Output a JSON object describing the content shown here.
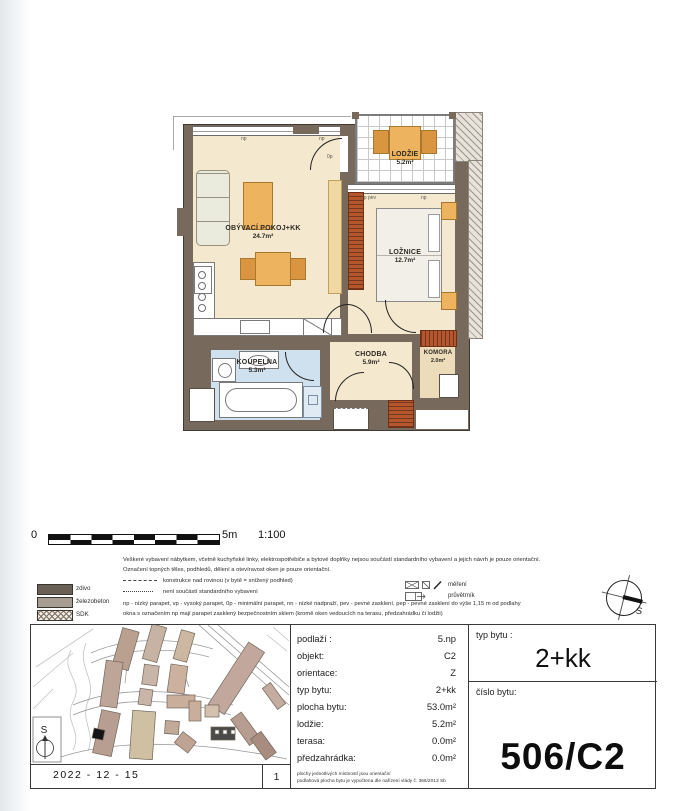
{
  "plan": {
    "rooms": {
      "obyvaci": {
        "name": "OBÝVACÍ POKOJ+KK",
        "area": "24.7m²"
      },
      "loznice": {
        "name": "LOŽNICE",
        "area": "12.7m²"
      },
      "lodzie": {
        "name": "LODŽIE",
        "area": "5.2m²"
      },
      "chodba": {
        "name": "CHODBA",
        "area": "5.9m²"
      },
      "koupelna": {
        "name": "KOUPELNA",
        "area": "5.3m²"
      },
      "komora": {
        "name": "KOMORA",
        "area": "2.0m²"
      }
    },
    "window_labels": {
      "a": "np",
      "b": "np",
      "c": "0p",
      "d": "np pev",
      "e": "np"
    }
  },
  "scale": {
    "zero": "0",
    "five": "5m",
    "ratio": "1:100"
  },
  "legend": {
    "notes": [
      "Veškeré vybavení nábytkem, včetně kuchyňské linky, elektrospotřebiče a bytové doplňky nejsou součástí standardního vybavení a jejich návrh je pouze orientační.",
      "Označení topných těles, podhledů, dělení a otevíravost oken je pouze orientační.",
      "konstrukce nad rovinou (v bytě = snížený podhled)",
      "není součástí standardního vybavení",
      "np - nízký parapet, vp - vysoký parapet, 0p - minimální parapet, nn - nízké nadpraží, pev - pevné zasklení, pep - pevné zasklení do výše 1,15 m od podlahy",
      "okna s označením np mají parapet zasklený bezpečnostním sklem (kromě oken vedoucích na terasu, předzahrádku či lodžii)"
    ],
    "materials": [
      {
        "label": "zdivo"
      },
      {
        "label": "železobeton"
      },
      {
        "label": "SDK"
      }
    ],
    "symbols": [
      {
        "label": "měření"
      },
      {
        "label": "průvětrník"
      }
    ]
  },
  "compass": {
    "label": "S"
  },
  "map": {
    "compass_label": "S"
  },
  "info": {
    "rows": [
      {
        "label": "podlaží :",
        "value": "5.np"
      },
      {
        "label": "objekt:",
        "value": "C2"
      },
      {
        "label": "orientace:",
        "value": "Z"
      },
      {
        "label": "typ bytu:",
        "value": "2+kk"
      },
      {
        "label": "plocha bytu:",
        "value": "53.0m²"
      },
      {
        "label": "lodžie:",
        "value": "5.2m²"
      },
      {
        "label": "terasa:",
        "value": "0.0m²"
      },
      {
        "label": "předzahrádka:",
        "value": "0.0m²"
      }
    ],
    "fine_print": [
      "plochy jednotlivých místností jsou orientační",
      "podlahová plocha bytu je vypočtena dle nařízení vlády č. 366/2013 Sb"
    ]
  },
  "unit": {
    "typ_label": "typ bytu :",
    "typ_value": "2+kk",
    "cislo_label": "číslo bytu:",
    "cislo_value": "506/C2"
  },
  "footer": {
    "date": "2022 - 12 - 15",
    "page": "1"
  }
}
